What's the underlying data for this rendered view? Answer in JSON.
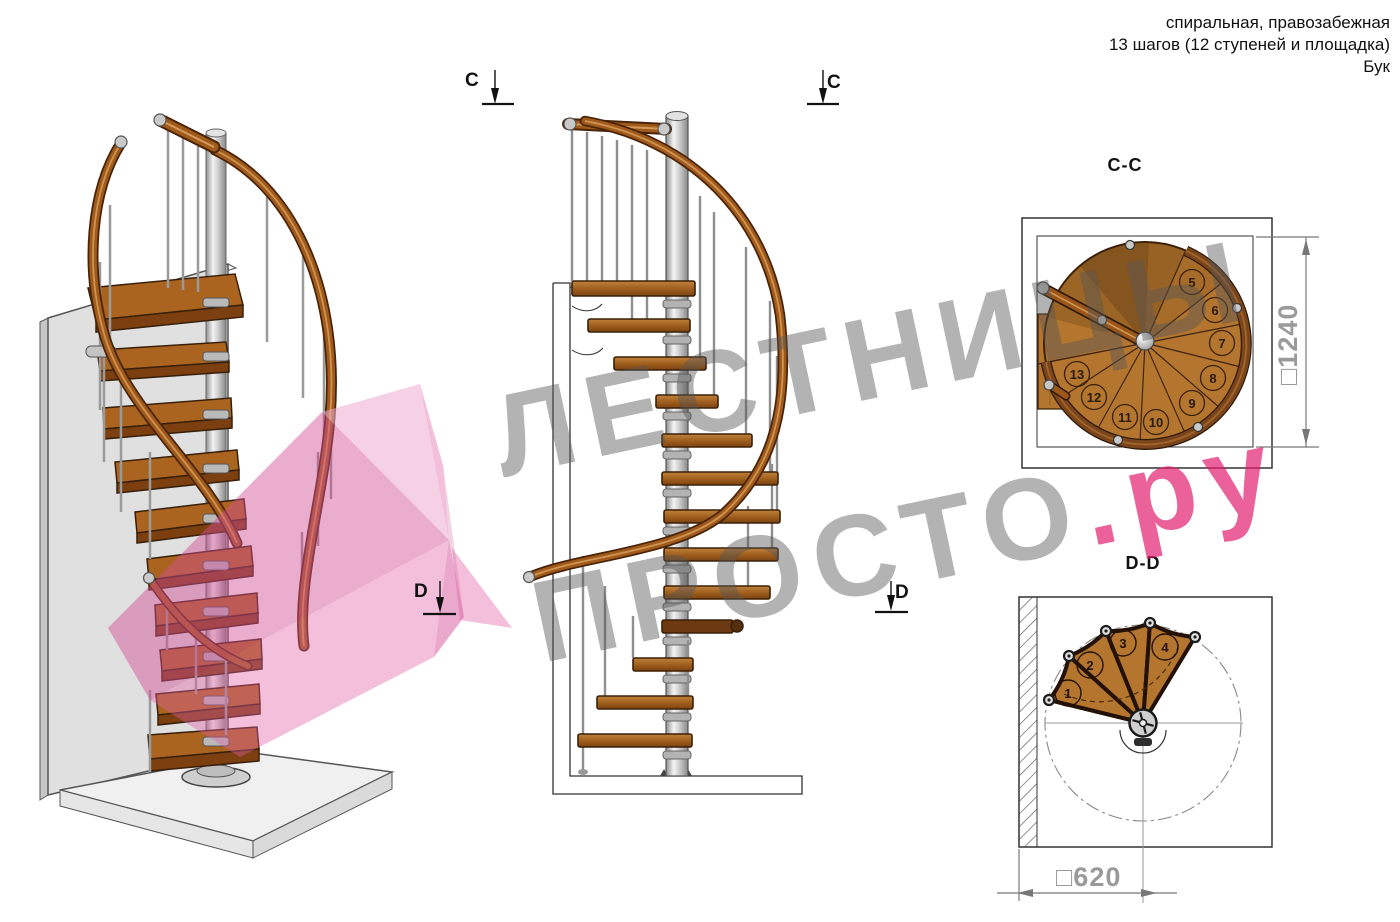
{
  "header": {
    "line1": "спиральная, правозабежная",
    "line2": "13 шагов (12 ступеней и площадка)",
    "line3": "Бук"
  },
  "section_markers": {
    "c_left": "C",
    "c_right": "C",
    "d_left": "D",
    "d_right": "D"
  },
  "views": {
    "cc_title": "C-C",
    "dd_title": "D-D"
  },
  "dimensions": {
    "cc_size": "□1240",
    "dd_size": "□620"
  },
  "plan_cc": {
    "step_numbers": [
      "5",
      "6",
      "7",
      "8",
      "9",
      "10",
      "11",
      "12",
      "13"
    ]
  },
  "plan_dd": {
    "step_numbers": [
      "1",
      "2",
      "3",
      "4"
    ]
  },
  "watermark": {
    "line1": "ЛЕСТНИЦЫ",
    "line2": "ПРОСТО",
    "line2_suffix": ".ру"
  },
  "colors": {
    "wood": "#b4762e",
    "wood_dark": "#7a451a",
    "rail": "#9c5718",
    "metal": "#c9c9c9",
    "pink_watermark": "#ec7fae",
    "gray_watermark": "#b5b5b5",
    "dimension_gray": "#9a9a9a"
  }
}
